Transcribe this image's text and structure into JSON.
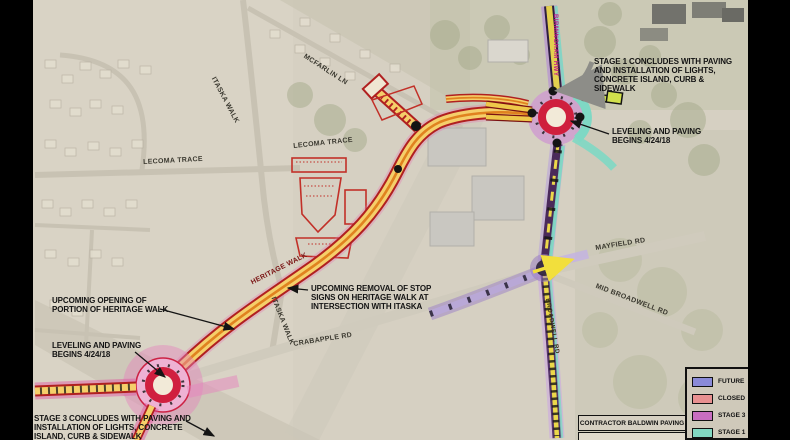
{
  "legend": {
    "items": [
      {
        "label": "FUTURE",
        "color": "#8a8ad8"
      },
      {
        "label": "CLOSED",
        "color": "#e89090"
      },
      {
        "label": "STAGE 3",
        "color": "#c86ec0"
      },
      {
        "label": "STAGE 1",
        "color": "#82d8c2"
      }
    ]
  },
  "contractor": {
    "label": "CONTRACTOR BALDWIN PAVING"
  },
  "annotations": {
    "stage1_concludes": "STAGE 1 CONCLUDES WITH PAVING AND INSTALLATION OF LIGHTS, CONCRETE ISLAND, CURB & SIDEWALK",
    "leveling_ne": "LEVELING AND PAVING BEGINS 4/24/18",
    "upcoming_opening": "UPCOMING OPENING OF PORTION OF HERITAGE WALK",
    "leveling_sw": "LEVELING AND PAVING BEGINS 4/24/18",
    "stage3_concludes": "STAGE 3 CONCLUDES WITH PAVING AND INSTALLATION OF LIGHTS, CONCRETE ISLAND, CURB & SIDEWALK",
    "stop_sign_removal": "UPCOMING REMOVAL OF STOP SIGNS ON HERITAGE WALK AT INTERSECTION WITH ITASKA"
  },
  "road_labels": {
    "itaska_walk_north": "ITASKA WALK",
    "mcfarlin_ln": "MCFARLIN LN",
    "lecoma_trace_west": "LECOMA TRACE",
    "lecoma_trace_east": "LECOMA TRACE",
    "heritage_walk": "HERITAGE WALK",
    "itaska_walk_south": "ITASKA WALK",
    "crabapple_rd": "CRABAPPLE RD",
    "mayfield_rd": "MAYFIELD RD",
    "mid_broadwell_rd": "MID BROADWELL RD",
    "birmingham_hwy": "BIRMINGHAM HWY",
    "broadwell_rd": "BROADWELL RD"
  }
}
